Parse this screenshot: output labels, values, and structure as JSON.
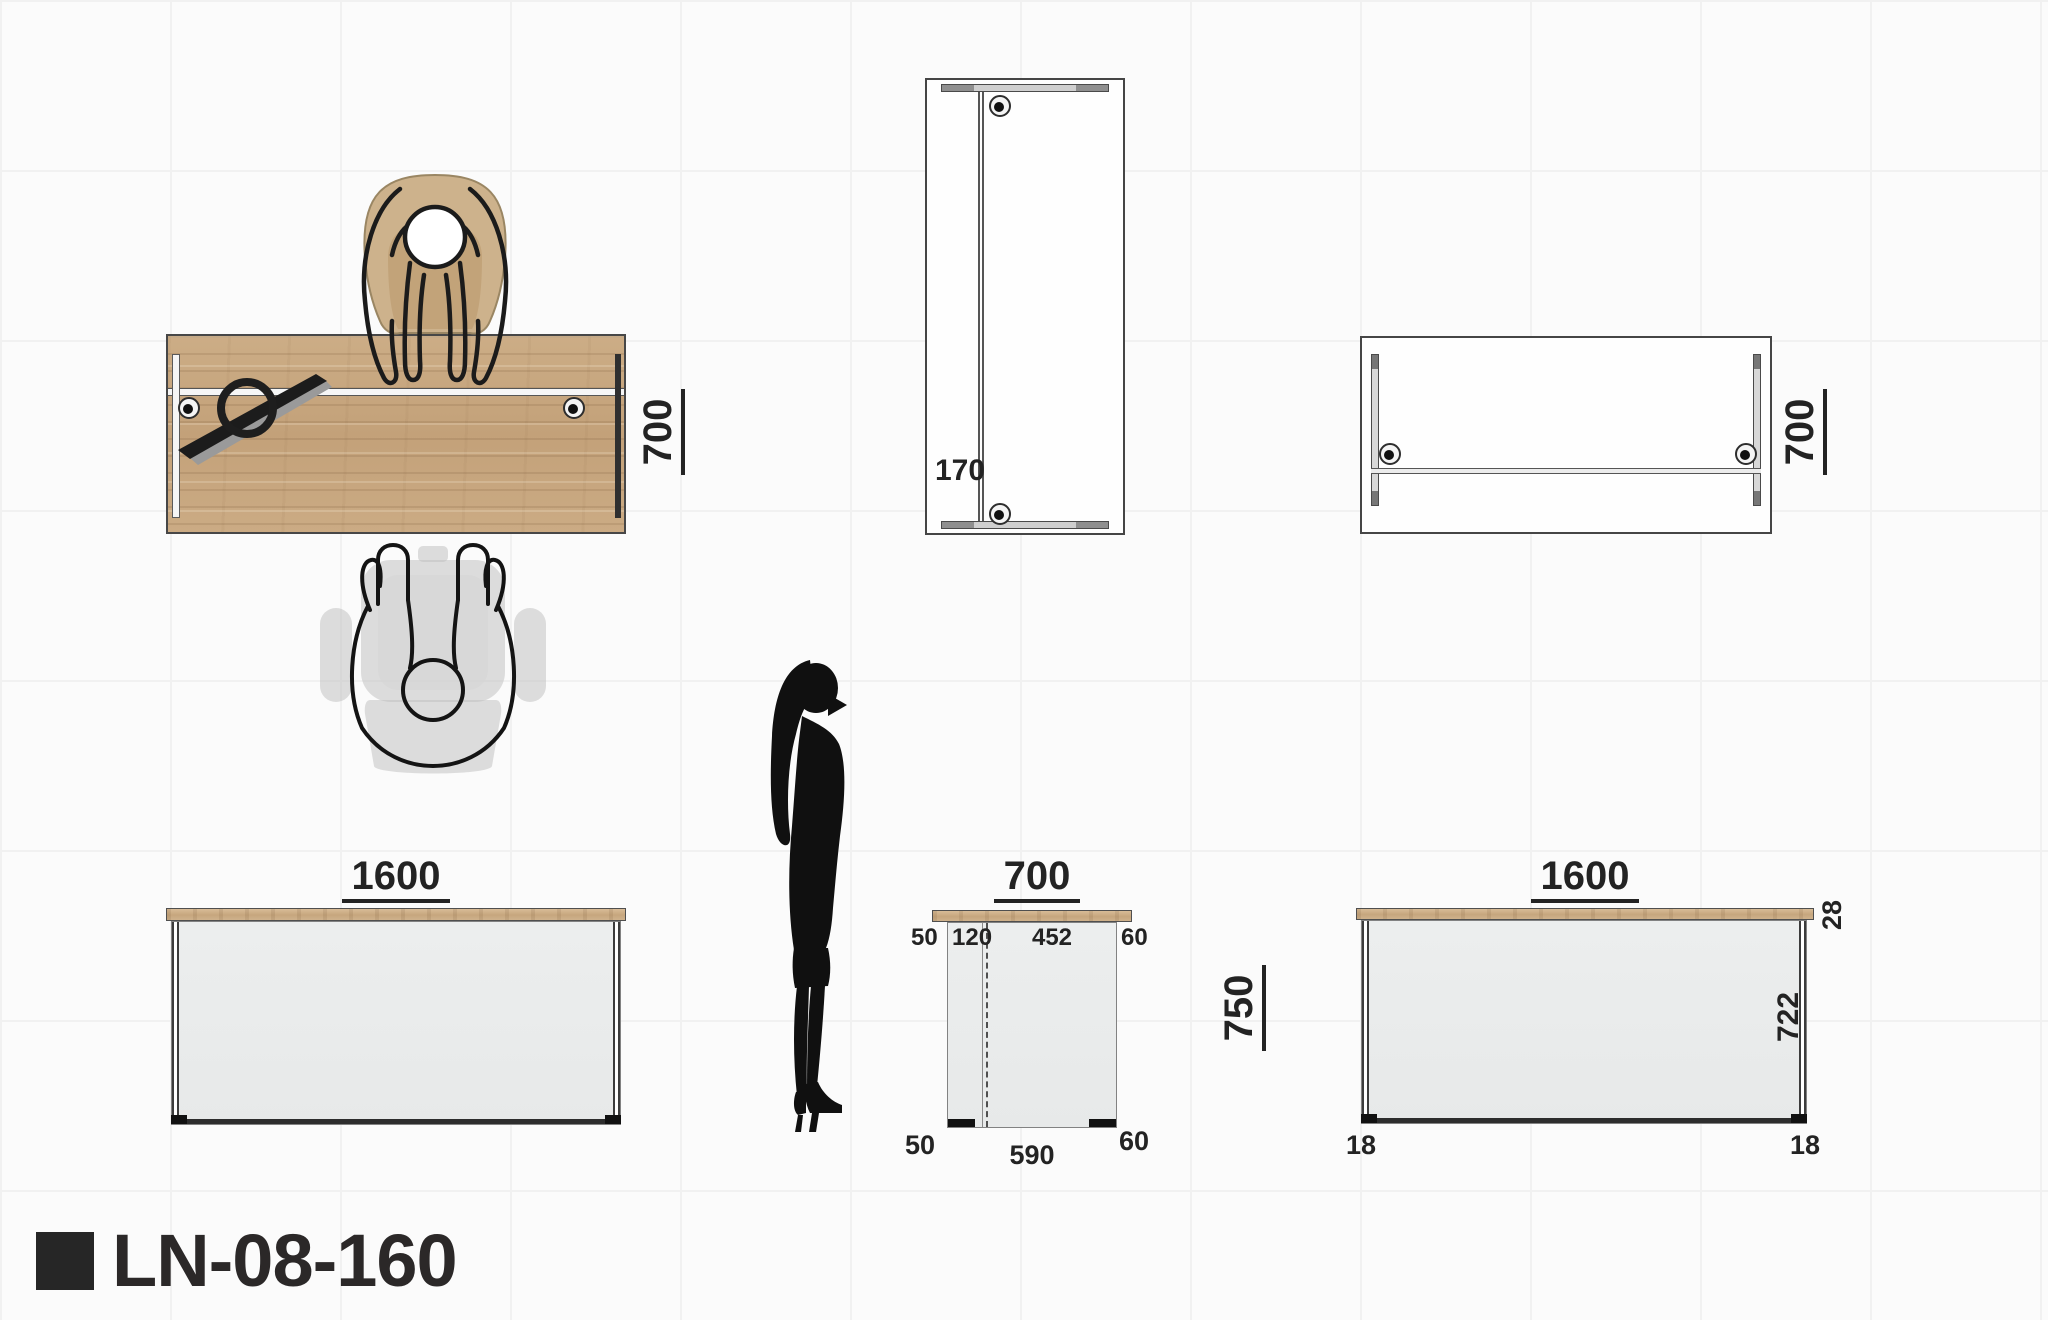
{
  "title": {
    "model": "LN-08-160"
  },
  "plan_top": {
    "depth_label": "700"
  },
  "plan_narrow": {
    "offset_label": "170"
  },
  "plan_underside": {
    "depth_label": "700"
  },
  "front_left": {
    "width_label": "1600"
  },
  "side": {
    "width_label": "700",
    "height_label": "750",
    "top_dims": [
      "50",
      "120",
      "452",
      "60"
    ],
    "bottom_dims": [
      "50",
      "590",
      "60"
    ]
  },
  "front_right": {
    "width_label": "1600",
    "top_thickness_label": "28",
    "panel_height_label": "722",
    "foot_labels": [
      "18",
      "18"
    ]
  },
  "icons": {
    "lamp": "desk-lamp-icon",
    "grommet": "cable-grommet-icon",
    "visitor_chair": "visitor-chair-with-person-icon",
    "task_chair": "office-chair-with-person-icon",
    "scale_figure": "human-scale-figure-icon"
  },
  "colors": {
    "wood": "#c9aa84",
    "panel": "#e9ebea",
    "outline": "#2e2e2e",
    "chair_beige": "#cdb28c",
    "ghost_gray": "#c2c2c2",
    "dimension_text": "#232323"
  }
}
